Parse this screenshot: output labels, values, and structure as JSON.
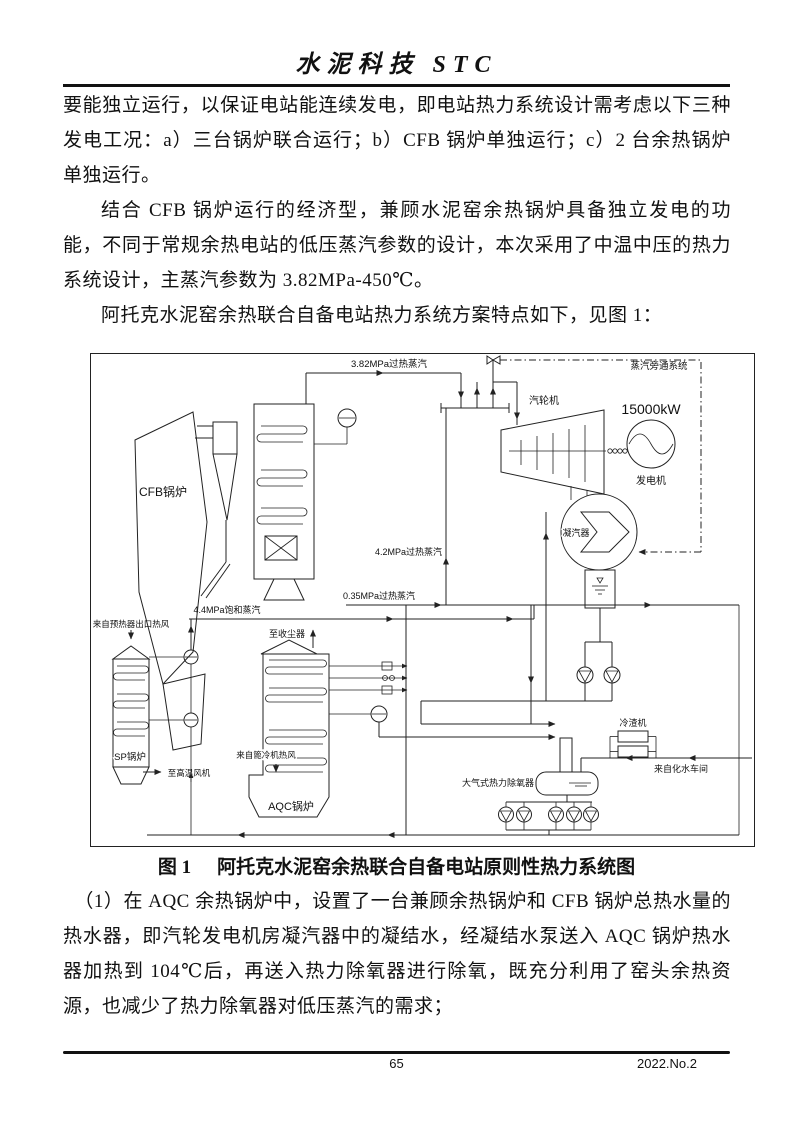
{
  "header": {
    "journal_title": "水泥科技 STC"
  },
  "body": {
    "p1": "要能独立运行，以保证电站能连续发电，即电站热力系统设计需考虑以下三种发电工况：a）三台锅炉联合运行；b）CFB 锅炉单独运行；c）2 台余热锅炉单独运行。",
    "p2": "结合 CFB 锅炉运行的经济型，兼顾水泥窑余热锅炉具备独立发电的功能，不同于常规余热电站的低压蒸汽参数的设计，本次采用了中温中压的热力系统设计，主蒸汽参数为 3.82MPa-450℃。",
    "p3": "阿托克水泥窑余热联合自备电站热力系统方案特点如下，见图 1：",
    "p4": "（1）在 AQC 余热锅炉中，设置了一台兼顾余热锅炉和 CFB 锅炉总热水量的热水器，即汽轮发电机房凝汽器中的凝结水，经凝结水泵送入 AQC 锅炉热水器加热到 104℃后，再送入热力除氧器进行除氧，既充分利用了窑头余热资源，也减少了热力除氧器对低压蒸汽的需求；"
  },
  "figure": {
    "caption_label": "图 1",
    "caption_text": "阿托克水泥窑余热联合自备电站原则性热力系统图",
    "labels": {
      "main_steam": "3.82MPa过热蒸汽",
      "bypass_system": "蒸汽旁通系统",
      "turbine": "汽轮机",
      "generator_power": "15000kW",
      "generator": "发电机",
      "condenser": "凝汽器",
      "steam_4_2": "4.2MPa过热蒸汽",
      "steam_0_35": "0.35MPa过热蒸汽",
      "steam_4_4": "4.4MPa饱和蒸汽",
      "cfb_boiler": "CFB锅炉",
      "sp_boiler": "SP锅炉",
      "aqc_boiler": "AQC锅炉",
      "from_preheater_air": "来自预热器出口热风",
      "to_high_temp_fan": "至高温风机",
      "to_dust_collector": "至收尘器",
      "from_grate_cooler_air": "来自篦冷机热风",
      "deaerator": "大气式热力除氧器",
      "slag_cooler": "冷渣机",
      "from_water_treatment": "来自化水车间"
    }
  },
  "footer": {
    "page_number": "65",
    "issue": "2022.No.2"
  }
}
